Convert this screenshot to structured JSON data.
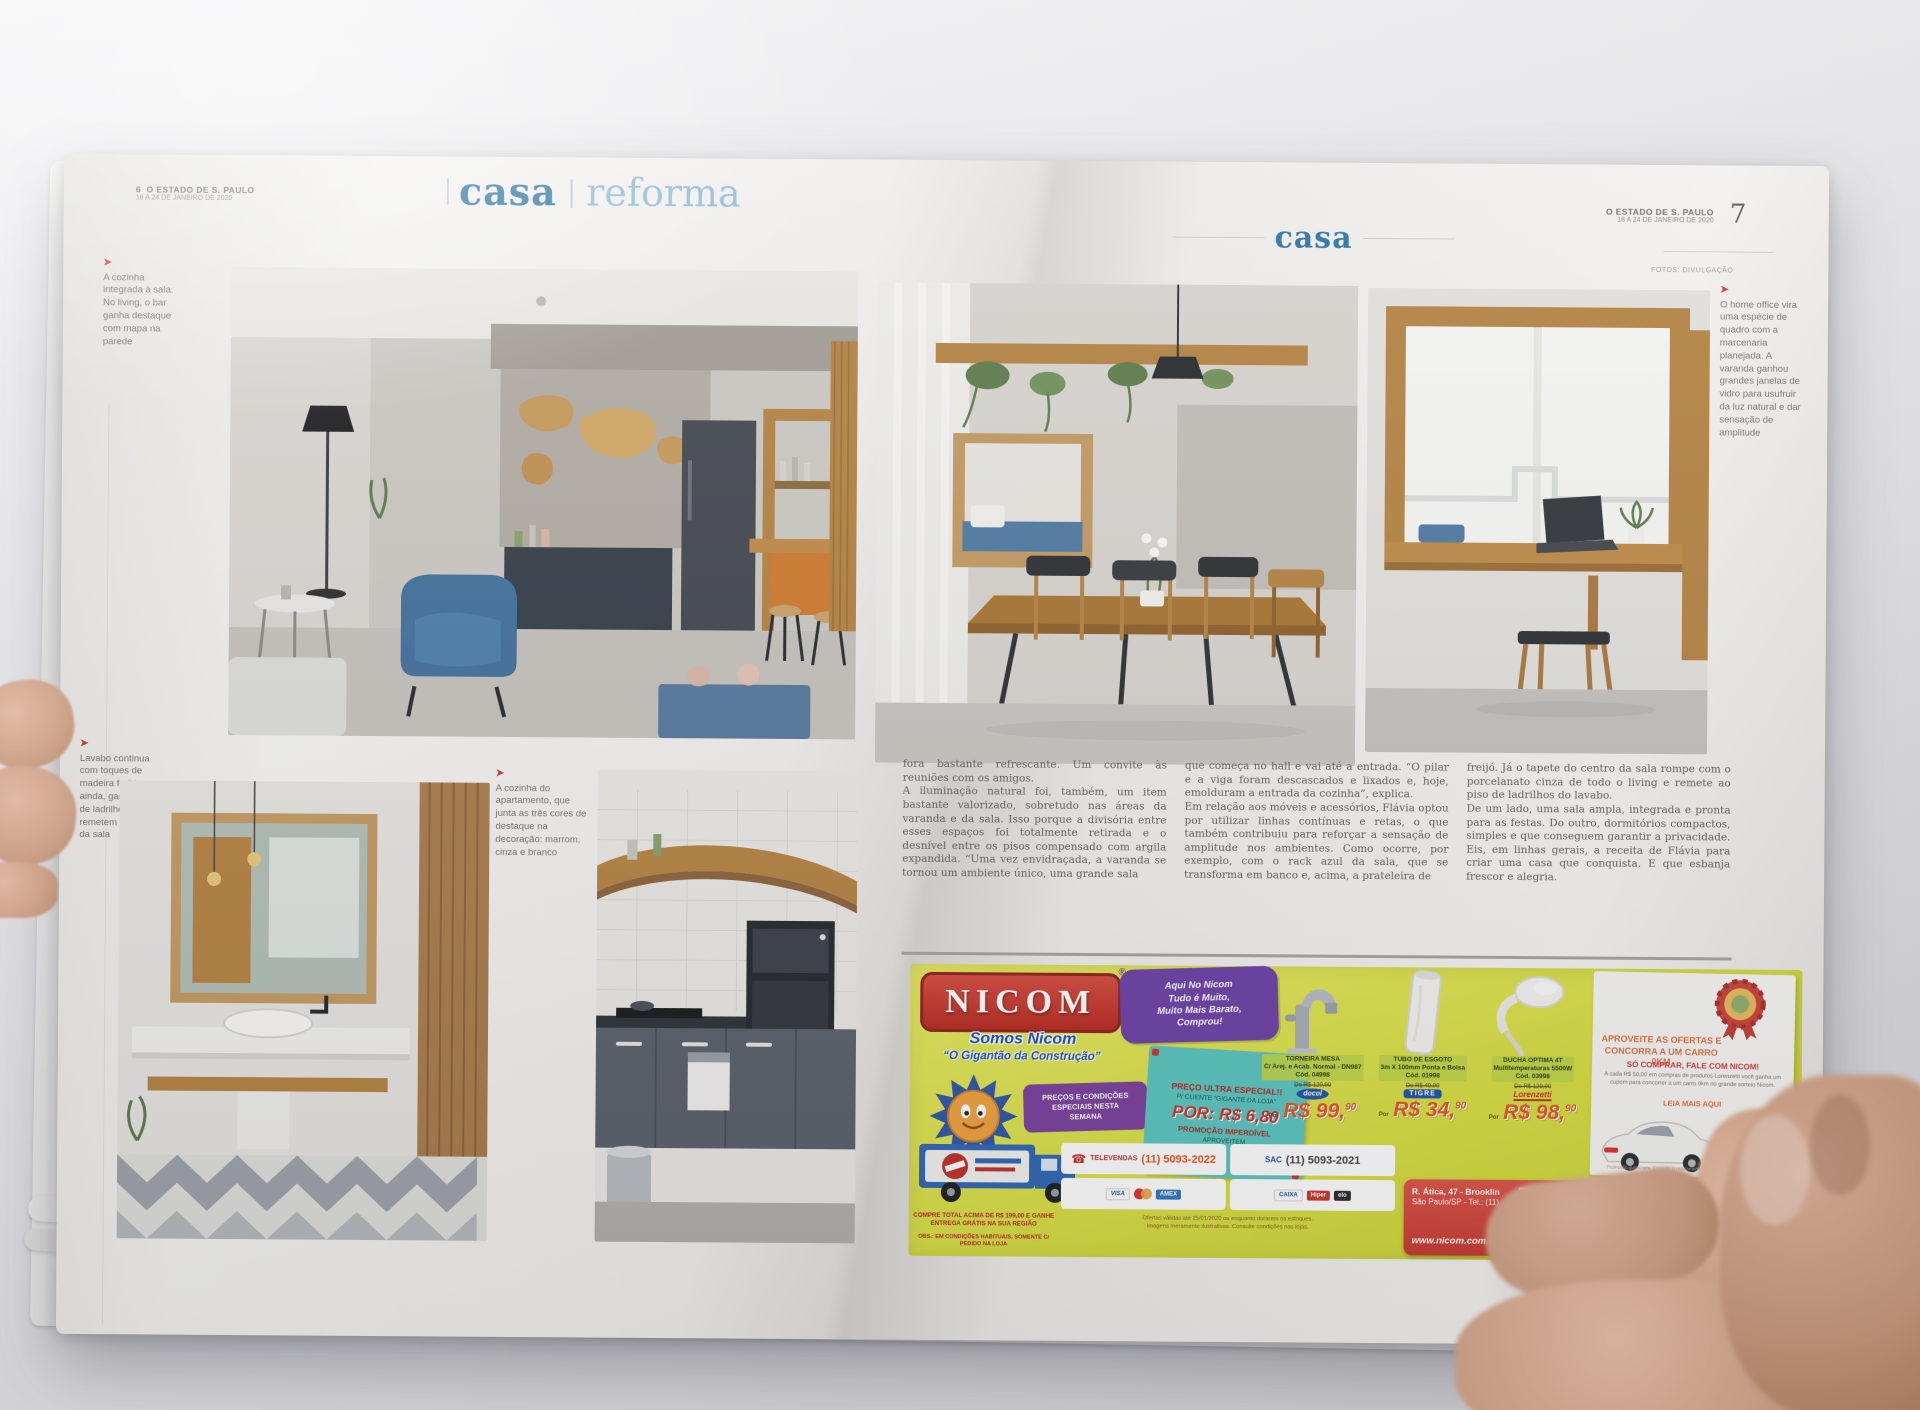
{
  "colors": {
    "header_blue": "#2a73a3",
    "header_light_blue": "#8dbcdb",
    "caption_arrow_red": "#c23b2e",
    "ad_yellow": "#d8df3f",
    "ad_red": "#c8372c",
    "price_orange": "#e2551f",
    "coupon_teal": "#59c6c0",
    "banner_red": "#c83a30",
    "seal_navy": "#24357d"
  },
  "left_page": {
    "folio": {
      "page": "6",
      "masthead": "O ESTADO DE S. PAULO",
      "date": "18 A 24 DE JANEIRO DE 2020"
    },
    "header": {
      "primary": "casa",
      "divider": "|",
      "secondary": "reforma"
    },
    "captions": {
      "arrow": "➤",
      "top": "A cozinha integrada à sala. No living, o bar ganha destaque com mapa na parede",
      "lavabo": "Lavabo continua com toques de madeira freijó e, ainda, ganha piso de ladrilhos que remetem ao tapete da sala",
      "cozinha": "A cozinha do apartamento, que junta as três cores de destaque na decoração: marrom, cinza e branco"
    }
  },
  "right_page": {
    "folio": {
      "masthead": "O ESTADO DE S. PAULO",
      "date": "18 A 24 DE JANEIRO DE 2020",
      "page": "7"
    },
    "header": {
      "primary": "casa"
    },
    "photo_credit": "FOTOS: DIVULGAÇÃO",
    "caption_office": "O home office vira uma espécie de quadro com a marcenaria planejada. A varanda ganhou grandes janelas de vidro para usufruir da luz natural e dar sensação de amplitude",
    "article": {
      "col1": "fora bastante refrescante. Um convite às reuniões com os amigos.\nA iluminação natural foi, também, um item bastante valorizado, sobretudo nas áreas da varanda e da sala. Isso porque a divisória entre esses espaços foi totalmente retirada e o desnível entre os pisos compensado com argila expandida. “Uma vez envidraçada, a varanda se tornou um ambiente único, uma grande sala",
      "col2": "que começa no hall e vai até a entrada. “O pilar e a viga foram descascados e lixados e, hoje, emolduram a entrada da cozinha”, explica.\nEm relação aos móveis e acessórios, Flávia optou por utilizar linhas contínuas e retas, o que também contribuiu para reforçar a sensação de amplitude nos ambientes. Como ocorre, por exemplo, com o rack azul da sala, que se transforma em banco e, acima, a prateleira de",
      "col3": "freijó. Já o tapete do centro da sala rompe com o porcelanato cinza de todo o living e remete ao piso de ladrilhos do lavabo.\nDe um lado, uma sala ampla, integrada e pronta para as festas. Do outro, dormitórios compactos, simples e que conseguem garantir a privacidade. Eis, em linhas gerais, a receita de Flávia para criar uma casa que conquista. E que esbanja frescor e alegria."
    }
  },
  "ad": {
    "brand": "NICOM",
    "reg": "®",
    "bubble": "Aqui No Nicom\nTudo é Muito,\nMuito Mais Barato,\nComprou!",
    "tagline1": "Somos Nicom",
    "tagline2": "“O Gigantão da Construção”",
    "promo_badge": "PREÇOS E CONDIÇÕES\nESPECIAIS NESTA\nSEMANA",
    "truck_note1": "COMPRE TOTAL ACIMA DE R$ 199,00 E GANHE ENTREGA GRÁTIS NA SUA REGIÃO",
    "truck_note2": "OBS.: EM CONDIÇÕES HABITUAIS, SOMENTE C/ PEDIDO NA LOJA",
    "coupon": {
      "line1": "PREÇO ULTRA ESPECIAL!!",
      "line2": "P/ CLIENTE “GIGANTE DA LOJA”",
      "price": "POR: R$ 6,80",
      "line3": "PROMOÇÃO IMPERDÍVEL",
      "line4": "APROVEITEM"
    },
    "por_label": "Por",
    "products": [
      {
        "name": "TORNEIRA MESA",
        "spec": "C/ Arej. e Acab. Normal - DN987",
        "code": "Cód. 04998",
        "was": "De R$ 129,90",
        "rs": "R$ ",
        "int": "99,",
        "cents": "90",
        "brand": "docol"
      },
      {
        "name": "TUBO DE ESGOTO",
        "spec": "3m X 100mm Ponta e Bolsa",
        "code": "Cód. 01998",
        "was": "De R$ 49,90",
        "rs": "R$ ",
        "int": "34,",
        "cents": "90",
        "brand": "TIGRE"
      },
      {
        "name": "DUCHA OPTIMA 4T",
        "spec": "Multitemperaturas 5500W",
        "code": "Cód. 03998",
        "was": "De R$ 129,90",
        "rs": "R$ ",
        "int": "98,",
        "cents": "90",
        "brand": "Lorenzetti"
      }
    ],
    "televendas": {
      "label": "TELEVENDAS",
      "phone": "(11) 5093-2022"
    },
    "sac": {
      "label": "SAC",
      "phone": "(11) 5093-2021"
    },
    "cards": {
      "visa": "VISA",
      "amex": "AMEX",
      "caixa": "CAIXA",
      "hiper": "Hiper",
      "elo": "elo"
    },
    "fine_print": "Ofertas válidas até 25/01/2020 ou enquanto durarem os estoques.\nImagens meramente ilustrativas. Consulte condições nas lojas.",
    "flyer": {
      "headline1": "APROVEITE AS OFERTAS E",
      "headline2": "CONCORRA A UM CARRO 0KM",
      "headline3": "SÓ COMPRAR, FALE COM NICOM!",
      "body": "A cada R$ 50,00 em compras de produtos Lorenzetti você ganha um cupom para concorrer a um carro 0km no grande sorteio Nicom.",
      "link": "LEIA MAIS AQUI",
      "brand": "Lorenzetti",
      "footnote": "Promoção autorizada. Consulte o regulamento nas lojas participantes."
    },
    "banner": {
      "address1": "R. Ática, 47 - Brooklin",
      "address2": "São Paulo/SP - Tel.: (11)",
      "site": "www.nicom.com.br",
      "phone1": "5093-2000",
      "phone2": "5093-1400",
      "seal_top": "MAIS DE",
      "seal_big": "100",
      "seal_bottom": "MIL CLIENTES"
    }
  }
}
